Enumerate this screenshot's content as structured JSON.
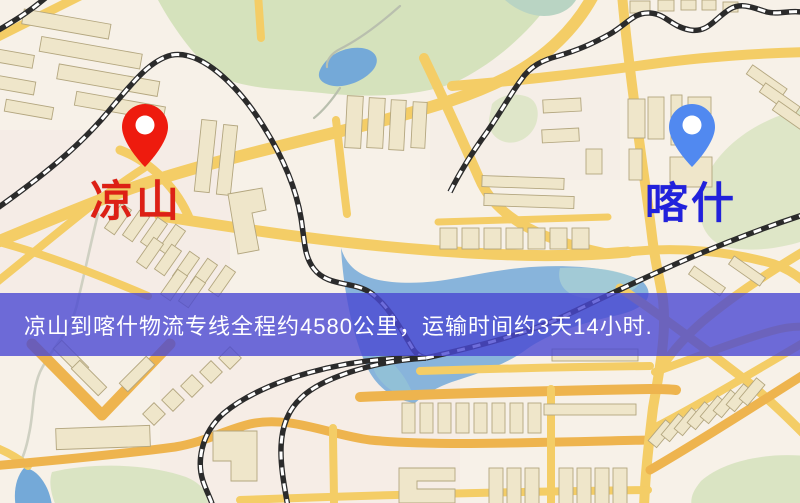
{
  "markers": {
    "origin": {
      "name": "凉山",
      "pin_color": "#ee1b0e",
      "label_color": "#dd2015"
    },
    "destination": {
      "name": "喀什",
      "pin_color": "#5189f0",
      "label_color": "#2121dc"
    }
  },
  "banner": {
    "text": "凉山到喀什物流专线全程约4580公里，运输时间约3天14小时.",
    "bg_rgba": "rgba(74,72,210,0.80)",
    "fg": "#ffffff"
  },
  "map_palette": {
    "background": "#f7f1e8",
    "road_major": "#f4cd66",
    "road_strong": "#eeb44e",
    "park": "#d5e2bc",
    "water": "#74a9d8",
    "railway": "#2b2b2b",
    "building_fill": "#efe6ca",
    "building_stroke": "#b3a67f"
  }
}
